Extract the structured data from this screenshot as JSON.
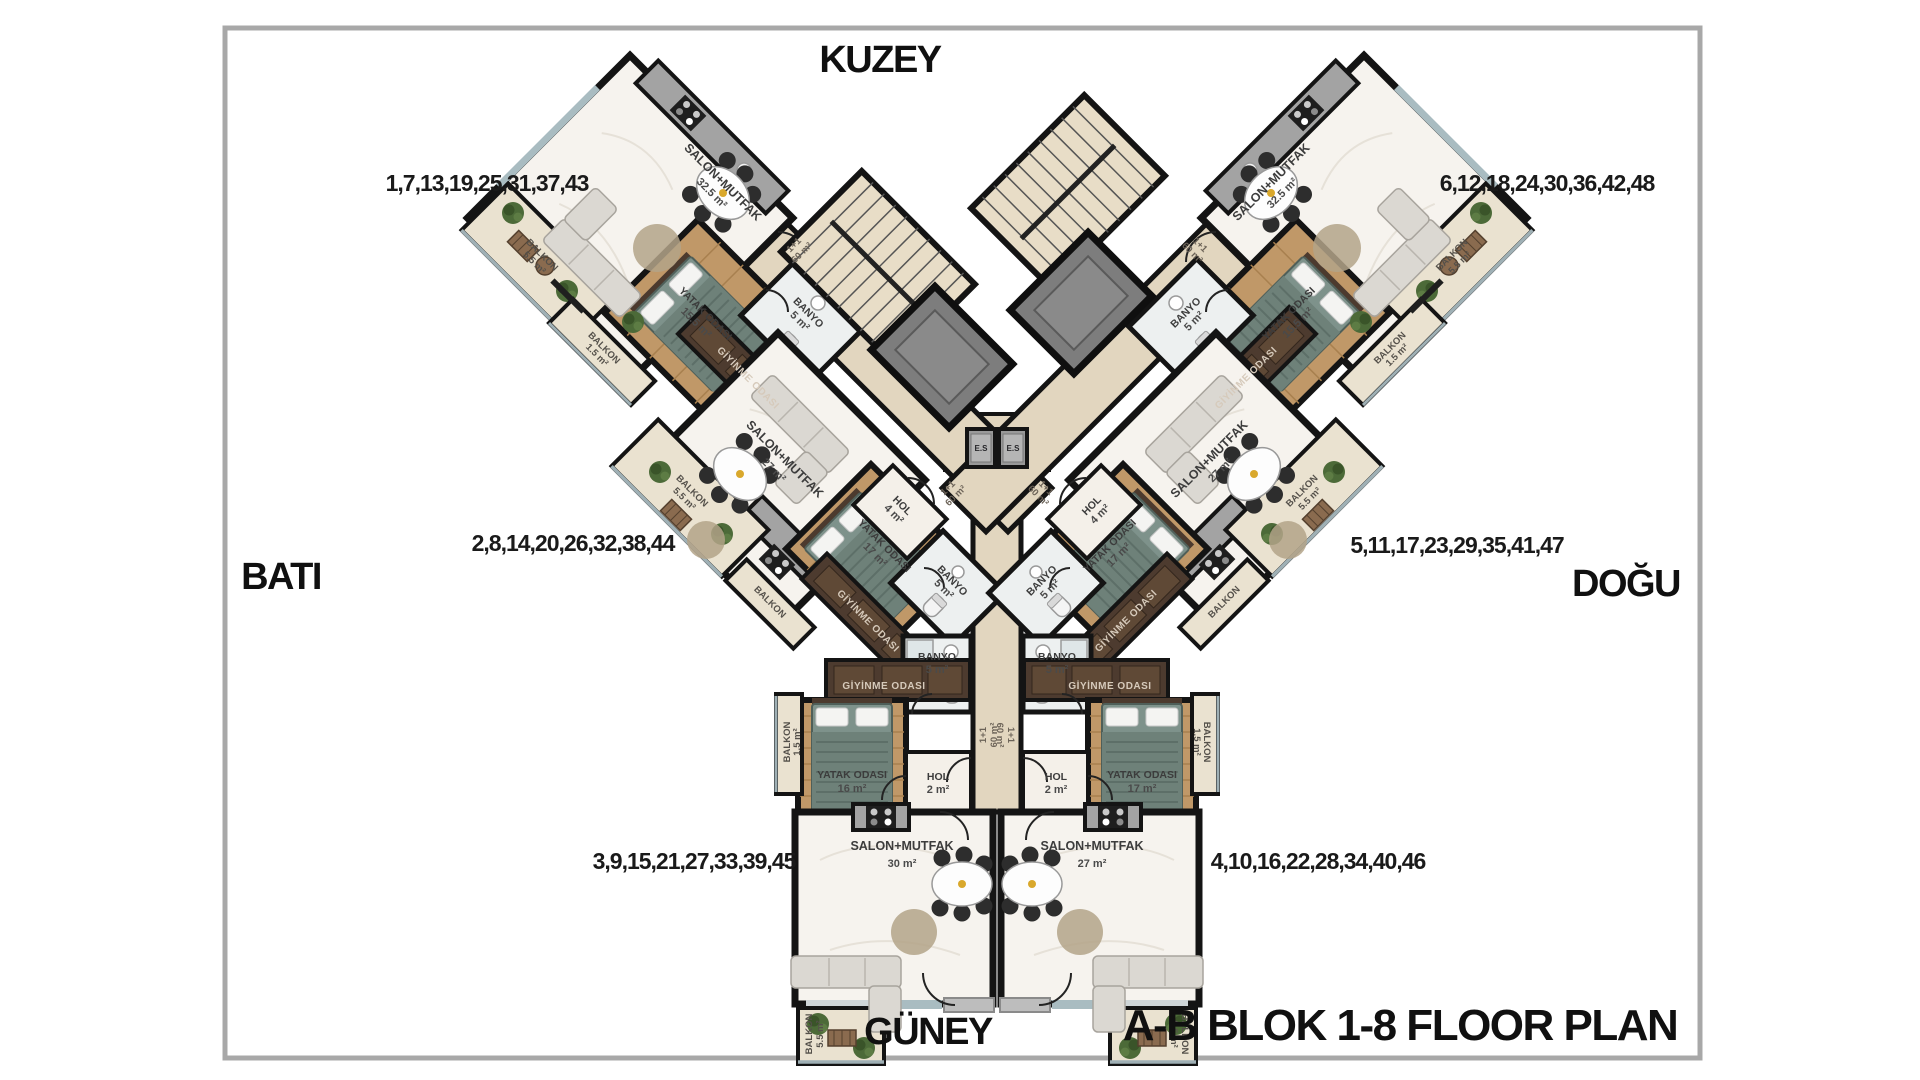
{
  "title": "A-B BLOK 1-8 FLOOR PLAN",
  "compass": {
    "north": "KUZEY",
    "south": "GÜNEY",
    "west": "BATI",
    "east": "DOĞU"
  },
  "apartment_numbers": {
    "block_a_north": "1,7,13,19,25,31,37,43",
    "block_b_north": "6,12,18,24,30,36,42,48",
    "block_a_middle": "2,8,14,20,26,32,38,44",
    "block_b_middle": "5,11,17,23,29,35,41,47",
    "block_a_south": "3,9,15,21,27,33,39,45",
    "block_b_south": "4,10,16,22,28,34,40,46"
  },
  "rooms": {
    "salon": "SALON+MUTFAK",
    "bedroom": "YATAK ODASI",
    "dressing": "GİYİNME ODASI",
    "bath": "BANYO",
    "hall": "HOL",
    "balcony": "BALKON"
  },
  "areas": {
    "a1_salon": "32.5 m²",
    "a1_bedroom": "15.5 m²",
    "a1_bath": "5 m²",
    "a1_balcony": "5.5 m²",
    "a1_balcony2": "1.5 m²",
    "a2_salon": "27 m²",
    "a2_bedroom": "17 m²",
    "a2_bath": "5 m²",
    "a2_hall": "4 m²",
    "a2_balcony": "5.5 m²",
    "a2_balcony2": "1.5 m²",
    "a3_salon": "30 m²",
    "a3_bedroom": "16 m²",
    "a3_bath": "5 m²",
    "a3_hall": "2 m²",
    "a3_balcony": "5.5 m²",
    "a3_balcony2": "1.5 m²",
    "b1_salon": "32.5 m²",
    "b1_bedroom": "15.5 m²",
    "b1_bath": "5 m²",
    "b1_balcony": "5.5 m²",
    "b1_balcony2": "1.5 m²",
    "b2_salon": "27 m²",
    "b2_bedroom": "17 m²",
    "b2_bath": "5 m²",
    "b2_hall": "4 m²",
    "b2_balcony": "5.5 m²",
    "b2_balcony2": "1.5 m²",
    "b3_salon": "27 m²",
    "b3_bedroom": "17 m²",
    "b3_bath": "5 m²",
    "b3_hall": "2 m²",
    "b3_balcony": "5.5 m²",
    "b3_balcony2": "1.5 m²"
  },
  "corridor_unit": {
    "type": "1+1",
    "area": "60 m²"
  },
  "elevator": {
    "label": "E.S"
  },
  "colors": {
    "wall": "#141414",
    "corridor_floor": "#e2d6bf",
    "marble_floor": "#f6f3ee",
    "wood_floor": "#c09868",
    "wardrobe_dark": "#4d3b2f",
    "balcony_floor": "#eae2d0",
    "shaft_gray": "#7d7d7d",
    "window_blue": "#a9bcc1",
    "plant_green": "#4c6a38"
  }
}
